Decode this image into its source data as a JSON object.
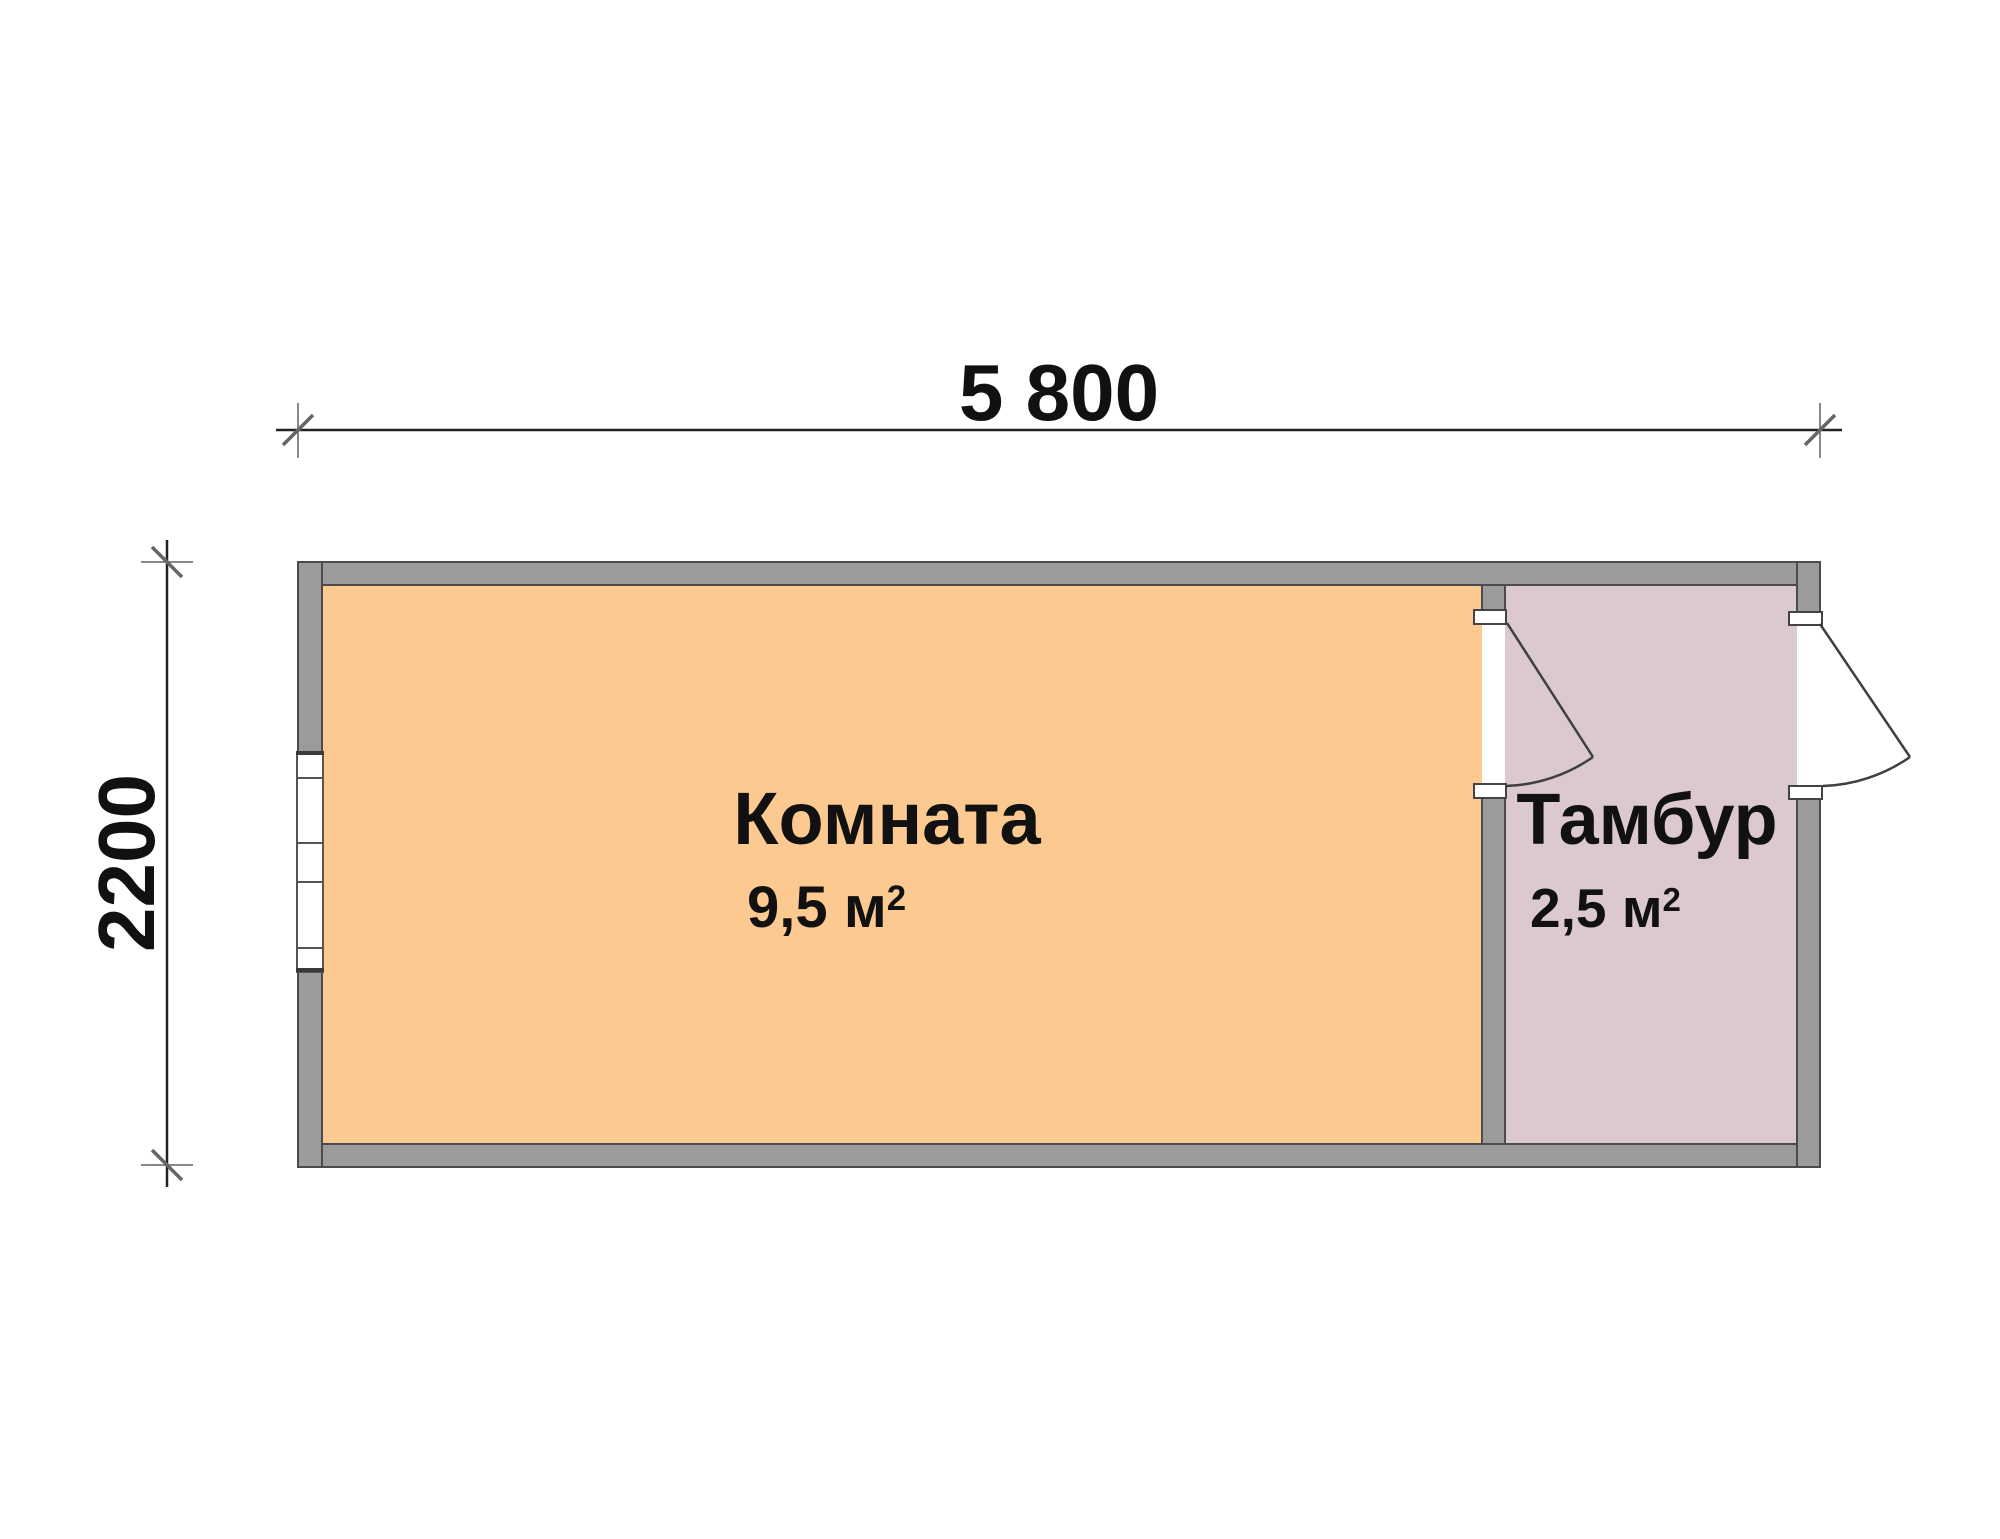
{
  "plan": {
    "title": "cabin-floor-plan",
    "rooms": [
      {
        "name": "Комната",
        "area_value": "9,5",
        "area_unit": "м",
        "area_sup": "2",
        "fill": "#fcca90"
      },
      {
        "name": "Тамбур",
        "area_value": "2,5",
        "area_unit": "м",
        "area_sup": "2",
        "fill": "#dbc9ce"
      }
    ],
    "dimensions": {
      "width_label": "5 800",
      "height_label": "2200"
    },
    "colors": {
      "room_fill": "#fcca90",
      "vestibule_fill": "#dbc9ce",
      "wall": "#9b9b9b",
      "wall_outline": "#4b4b4b",
      "line": "#3f3f3f",
      "dim_line": "#222222",
      "dim_ext": "#888888",
      "dim_tick": "#666666"
    }
  }
}
